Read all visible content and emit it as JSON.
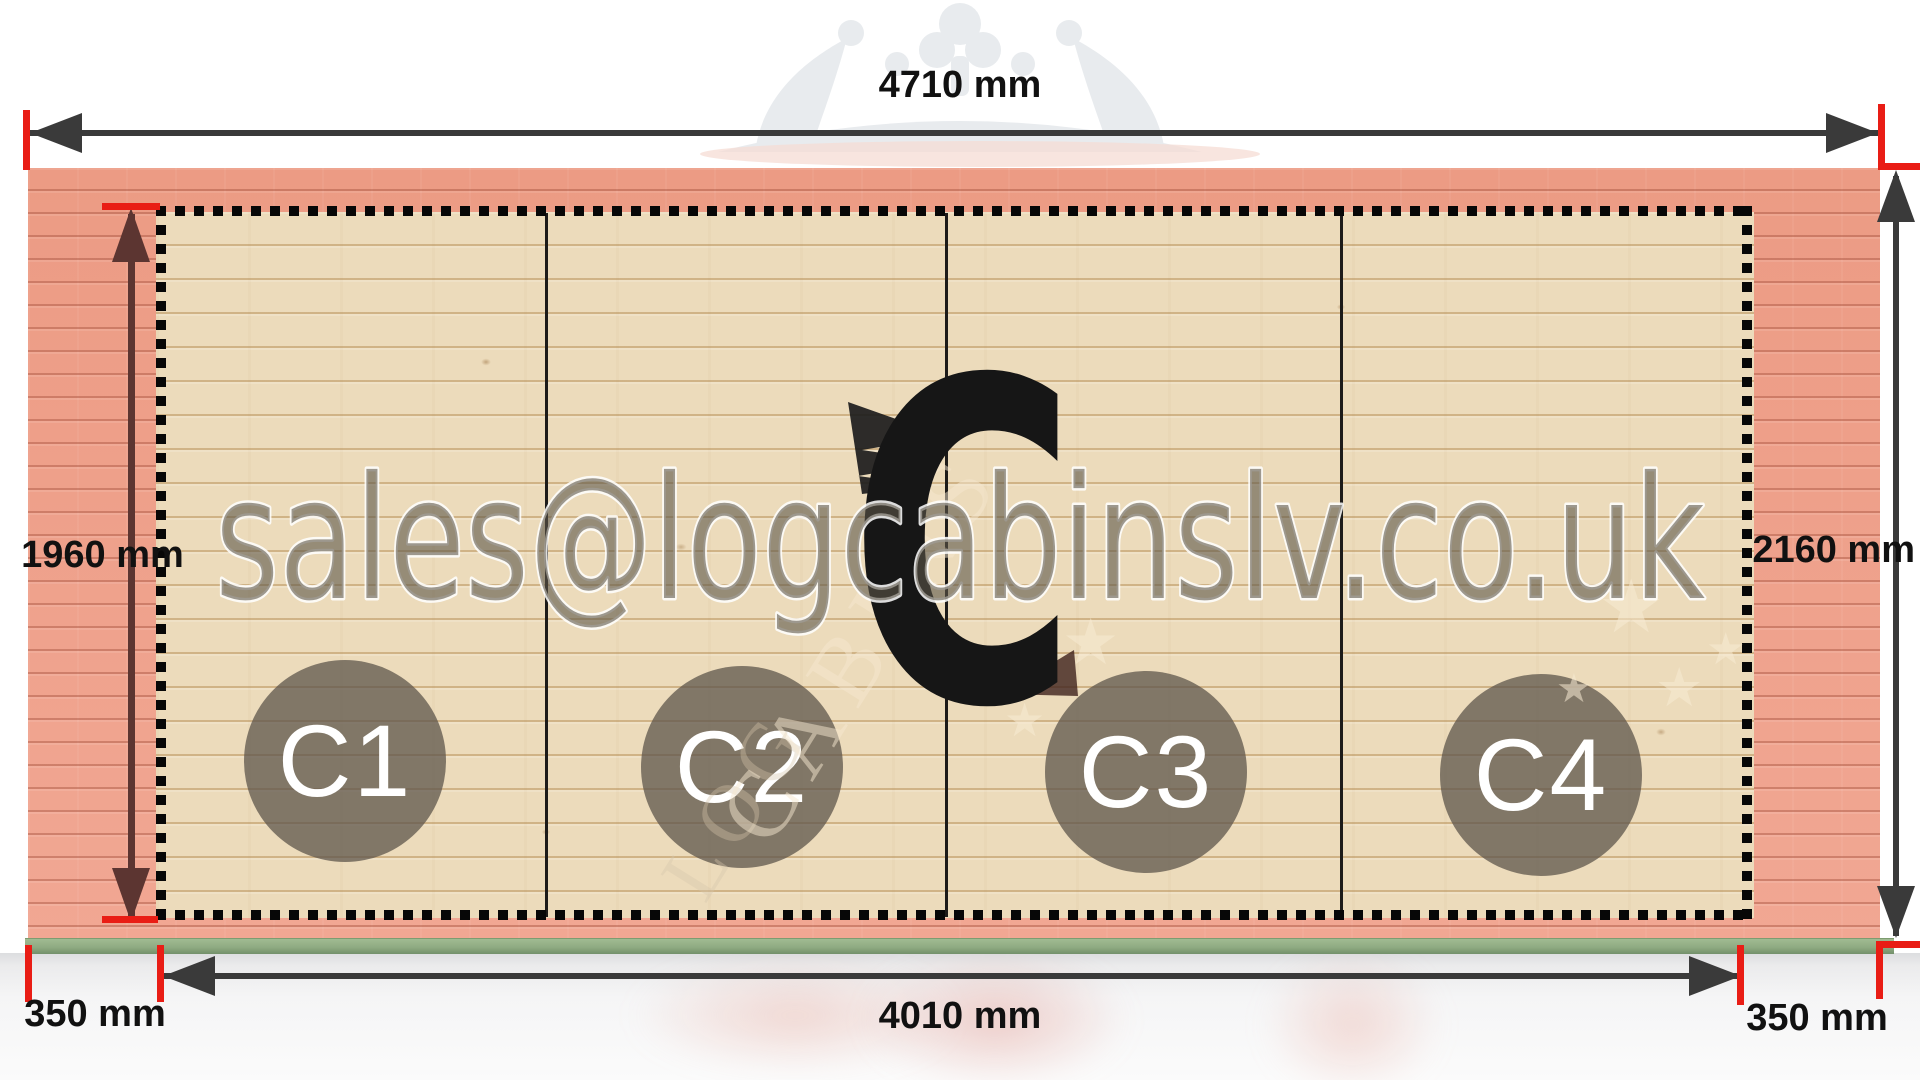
{
  "dimensions": {
    "top": "4710 mm",
    "left_inner": "1960 mm",
    "right": "2160 mm",
    "bottom_inner": "4010 mm",
    "overhang_left": "350 mm",
    "overhang_right": "350 mm"
  },
  "sections": [
    {
      "label": "C1"
    },
    {
      "label": "C2"
    },
    {
      "label": "C3"
    },
    {
      "label": "C4"
    }
  ],
  "center_mark": {
    "letter": "C"
  },
  "watermark": {
    "email": "sales@logcabinslv.co.uk",
    "crest_word_primary": "CABINS",
    "crest_word_secondary": "LOG"
  },
  "colors": {
    "dimension_line": "#3a3a3a",
    "tick_red": "#e91d15",
    "inner_arrow_maroon": "#5c3531",
    "outer_wood_pink": "#efa28f",
    "inner_wood_pale": "#ecdbbb",
    "base_green": "#8fab82",
    "section_circle": "rgba(92,84,74,0.74)",
    "big_letter": "#161616"
  }
}
